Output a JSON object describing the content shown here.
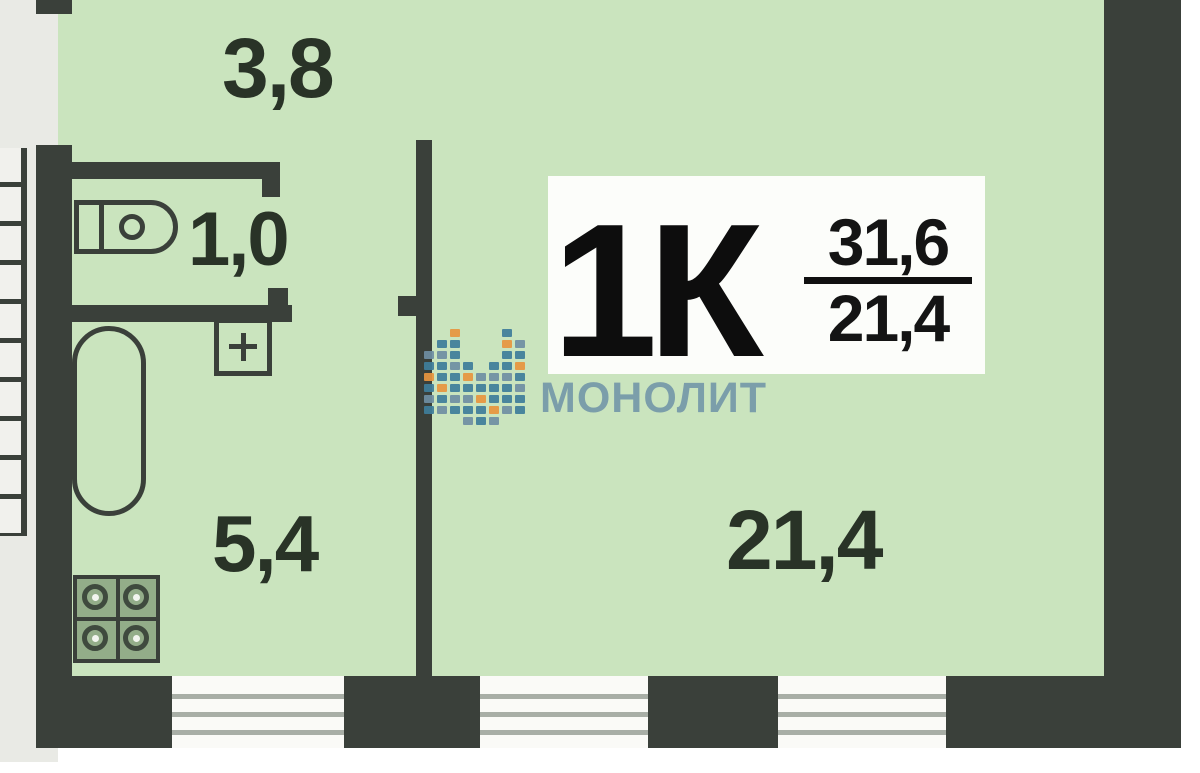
{
  "plan": {
    "type_label": "1К",
    "total_area": "31,6",
    "living_area": "21,4",
    "rooms": [
      {
        "id": "hallway",
        "area": "3,8"
      },
      {
        "id": "wc",
        "area": "1,0"
      },
      {
        "id": "kitchen-bathroom",
        "area": "5,4"
      },
      {
        "id": "living-room",
        "area": "21,4"
      }
    ],
    "fixtures": [
      "stairs-icon",
      "toilet-icon",
      "sink-icon",
      "bathtub-icon",
      "stove-icon"
    ],
    "windows_count": 3
  },
  "watermark": {
    "brand": "МОНОЛИТ",
    "text_color": "#6e92a7",
    "logo_colors": {
      "t": "#3f7e9b",
      "o": "#e8953f",
      "s": "#6f8fa3"
    },
    "logo_pattern": [
      [
        0,
        2,
        "s"
      ],
      [
        0,
        3,
        "t"
      ],
      [
        0,
        4,
        "o"
      ],
      [
        0,
        5,
        "t"
      ],
      [
        0,
        6,
        "s"
      ],
      [
        0,
        7,
        "t"
      ],
      [
        1,
        1,
        "t"
      ],
      [
        1,
        2,
        "s"
      ],
      [
        1,
        3,
        "t"
      ],
      [
        1,
        4,
        "t"
      ],
      [
        1,
        5,
        "o"
      ],
      [
        1,
        6,
        "t"
      ],
      [
        1,
        7,
        "s"
      ],
      [
        2,
        0,
        "o"
      ],
      [
        2,
        1,
        "t"
      ],
      [
        2,
        2,
        "t"
      ],
      [
        2,
        3,
        "s"
      ],
      [
        2,
        4,
        "t"
      ],
      [
        2,
        5,
        "t"
      ],
      [
        2,
        6,
        "s"
      ],
      [
        2,
        7,
        "t"
      ],
      [
        3,
        3,
        "t"
      ],
      [
        3,
        4,
        "o"
      ],
      [
        3,
        5,
        "t"
      ],
      [
        3,
        6,
        "s"
      ],
      [
        3,
        7,
        "t"
      ],
      [
        3,
        8,
        "s"
      ],
      [
        4,
        4,
        "s"
      ],
      [
        4,
        5,
        "t"
      ],
      [
        4,
        6,
        "o"
      ],
      [
        4,
        7,
        "t"
      ],
      [
        4,
        8,
        "t"
      ],
      [
        5,
        3,
        "t"
      ],
      [
        5,
        4,
        "s"
      ],
      [
        5,
        5,
        "t"
      ],
      [
        5,
        6,
        "t"
      ],
      [
        5,
        7,
        "o"
      ],
      [
        5,
        8,
        "s"
      ],
      [
        6,
        0,
        "t"
      ],
      [
        6,
        1,
        "o"
      ],
      [
        6,
        2,
        "t"
      ],
      [
        6,
        3,
        "t"
      ],
      [
        6,
        4,
        "s"
      ],
      [
        6,
        5,
        "t"
      ],
      [
        6,
        6,
        "t"
      ],
      [
        6,
        7,
        "s"
      ],
      [
        7,
        1,
        "s"
      ],
      [
        7,
        2,
        "t"
      ],
      [
        7,
        3,
        "o"
      ],
      [
        7,
        4,
        "t"
      ],
      [
        7,
        5,
        "s"
      ],
      [
        7,
        6,
        "t"
      ],
      [
        7,
        7,
        "t"
      ]
    ]
  },
  "colors": {
    "floor": "#cae4be",
    "wall": "#3a403a",
    "outside": "#e9eae5",
    "window_line": "#a8aea6",
    "label_box": "#fcfdfa",
    "dimension_text": "#293327",
    "type_text": "#0d0d0d"
  }
}
